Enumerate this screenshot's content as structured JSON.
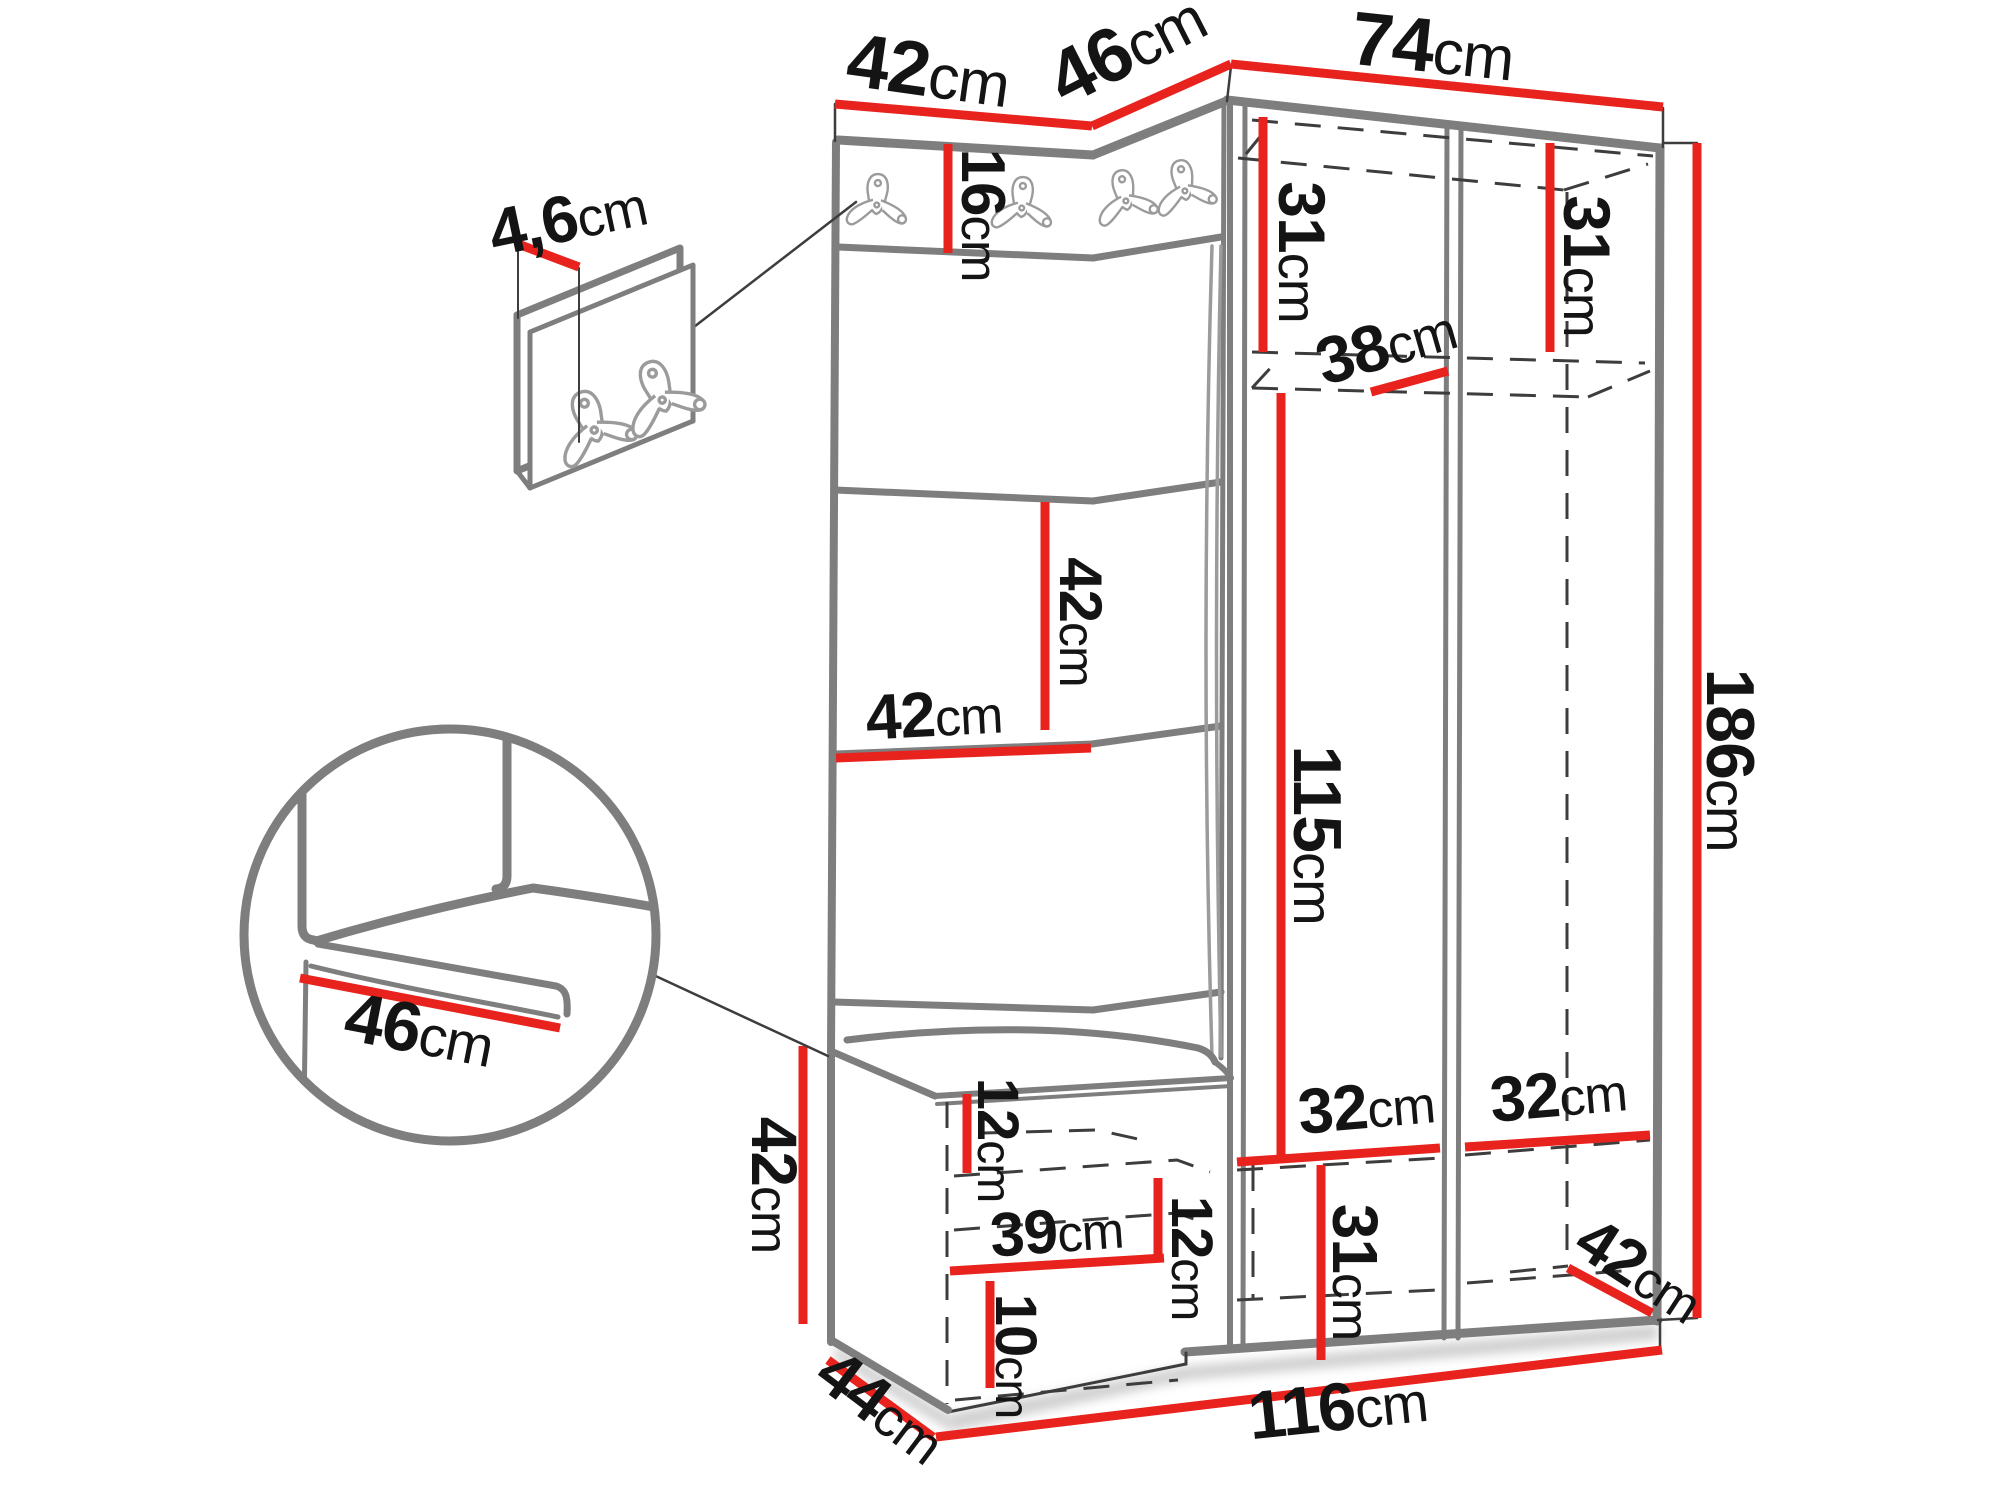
{
  "colors": {
    "dimension_red": "#e8231e",
    "edge_gray": "#7e7e7e",
    "detail_gray": "#9b9b9b",
    "line_dark": "#3d3d3d",
    "text_ink": "#141414",
    "background": "#ffffff"
  },
  "dims": {
    "top_left_width": {
      "value": "42",
      "unit": "cm"
    },
    "top_corner_width": {
      "value": "46",
      "unit": "cm"
    },
    "top_right_width": {
      "value": "74",
      "unit": "cm"
    },
    "hook_panel_depth": {
      "value": "4,6",
      "unit": "cm"
    },
    "hook_strip_height": {
      "value": "16",
      "unit": "cm"
    },
    "left_bay_top_height": {
      "value": "31",
      "unit": "cm"
    },
    "right_bay_top_height": {
      "value": "31",
      "unit": "cm"
    },
    "shelf_depth": {
      "value": "38",
      "unit": "cm"
    },
    "panel_tile_height": {
      "value": "42",
      "unit": "cm"
    },
    "panel_tile_width": {
      "value": "42",
      "unit": "cm"
    },
    "interior_height": {
      "value": "115",
      "unit": "cm"
    },
    "total_height": {
      "value": "186",
      "unit": "cm"
    },
    "seat_depth": {
      "value": "46",
      "unit": "cm"
    },
    "bench_height": {
      "value": "42",
      "unit": "cm"
    },
    "cushion_thickness": {
      "value": "12",
      "unit": "cm"
    },
    "bench_shelf_width": {
      "value": "39",
      "unit": "cm"
    },
    "bench_gap_height": {
      "value": "12",
      "unit": "cm"
    },
    "bench_lower_height": {
      "value": "10",
      "unit": "cm"
    },
    "base_depth": {
      "value": "44",
      "unit": "cm"
    },
    "total_width": {
      "value": "116",
      "unit": "cm"
    },
    "left_bay_width": {
      "value": "32",
      "unit": "cm"
    },
    "right_bay_width": {
      "value": "32",
      "unit": "cm"
    },
    "bottom_section_height": {
      "value": "31",
      "unit": "cm"
    },
    "bottom_shelf_depth": {
      "value": "42",
      "unit": "cm"
    }
  }
}
